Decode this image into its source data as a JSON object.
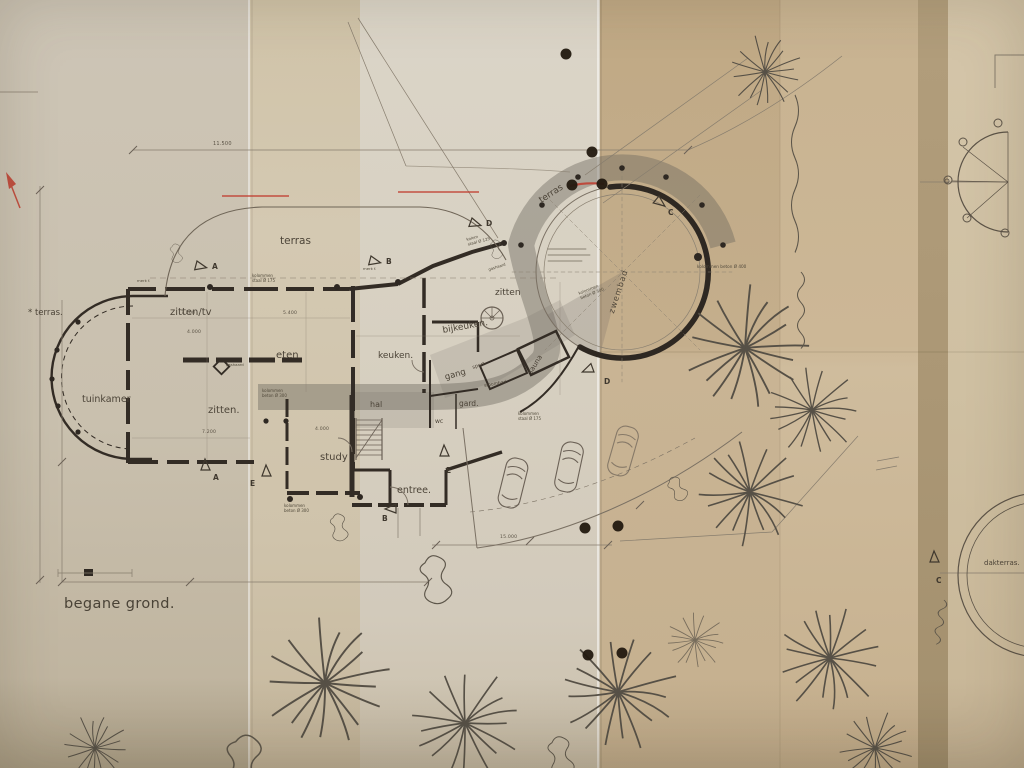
{
  "plan": {
    "floor_label": "begane grond.",
    "rooms": {
      "terras_left": "* terras.",
      "tuinkamer": "tuinkamer",
      "zitten_tv": "zitten/tv",
      "eten": "eten",
      "zitten": "zitten.",
      "keuken": "keuken.",
      "bijkeuken": "bijkeuken.",
      "zitten_sunken": "zitten",
      "gang": "gang",
      "sport": "sport.",
      "sauna": "sauna",
      "stoombad": "stoombad",
      "gard": "gard.",
      "wc": "wc",
      "hal": "hal",
      "study": "study",
      "entree": "entree.",
      "terras_top": "terras",
      "terras_pool": "terras",
      "zwembad": "zwembad",
      "dakterras": "dakterras."
    },
    "annotations": {
      "gashaard": "gashaard",
      "gashaard2": "gashaard",
      "kol_staal_175_a": "kolommen\nstaal Ø 175",
      "kol_staal_175_b": "kolommen\nstaal Ø 175",
      "kol_staal_125": "kolom\nstaal Ø 125",
      "kol_beton_300_a": "kolommen\nbeton Ø 300",
      "kol_beton_300_b": "kolommen\nbeton Ø 300",
      "kol_beton_300_c": "kolommen\nbeton Ø 300",
      "kol_beton_400": "kolommen beton Ø 400",
      "merk_f": "merk f."
    },
    "dimensions": {
      "d11500": "11.500",
      "d7200a": "7.200",
      "d5400": "5.400",
      "d4000a": "4.000",
      "d7200b": "7.200",
      "d4000b": "4.000",
      "d15000": "15.000"
    },
    "markers": {
      "a": "A",
      "b": "B",
      "c": "C",
      "d": "D",
      "e": "E"
    },
    "red_note": "Ø 5500"
  }
}
